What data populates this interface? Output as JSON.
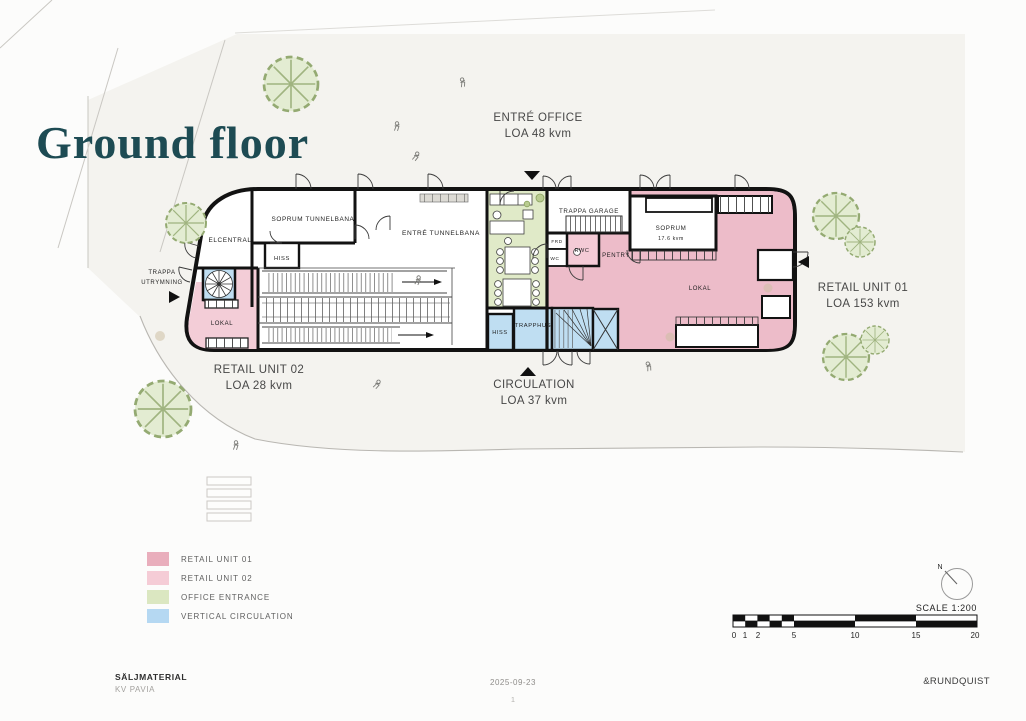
{
  "title": "Ground floor",
  "plan": {
    "rooms": {
      "soprum_tunnelbana": "SOPRUM TUNNELBANA",
      "elcentral": "ELCENTRAL",
      "hiss_left": "HISS",
      "entre_tunnelbana": "ENTRÉ TUNNELBANA",
      "trappa_garage": "TRAPPA GARAGE",
      "soprum": "SOPRUM",
      "soprum_area": "17.6 kvm",
      "frd": "FRD",
      "wc": "WC",
      "rwc": "RWC",
      "pentry": "PENTRY",
      "lokal_retail_01": "LOKAL",
      "lokal_retail_02": "LOKAL",
      "hiss_core": "HISS",
      "trapphus": "TRAPPHUS",
      "trappa_utrymning_line1": "TRAPPA",
      "trappa_utrymning_line2": "UTRYMNING"
    },
    "annotations": {
      "entre_office": {
        "name": "ENTRÉ OFFICE",
        "area": "LOA 48 kvm"
      },
      "retail_unit_01": {
        "name": "RETAIL UNIT 01",
        "area": "LOA 153 kvm"
      },
      "retail_unit_02": {
        "name": "RETAIL UNIT 02",
        "area": "LOA 28 kvm"
      },
      "circulation": {
        "name": "CIRCULATION",
        "area": "LOA 37 kvm"
      }
    }
  },
  "legend": {
    "items": [
      {
        "label": "RETAIL UNIT 01",
        "color": "#e9aebc"
      },
      {
        "label": "RETAIL UNIT 02",
        "color": "#f5ccd6"
      },
      {
        "label": "OFFICE ENTRANCE",
        "color": "#dbe7c1"
      },
      {
        "label": "VERTICAL CIRCULATION",
        "color": "#b5d8f2"
      }
    ]
  },
  "compass": {
    "north_label": "N"
  },
  "scale_bar": {
    "label": "SCALE 1:200",
    "ticks": [
      "0",
      "1",
      "2",
      "5",
      "10",
      "15",
      "20"
    ]
  },
  "footer": {
    "material": "SÄLJMATERIAL",
    "project": "KV PAVIA",
    "date": "2025-09-23",
    "page_number": "1",
    "company": "&RUNDQUIST"
  }
}
